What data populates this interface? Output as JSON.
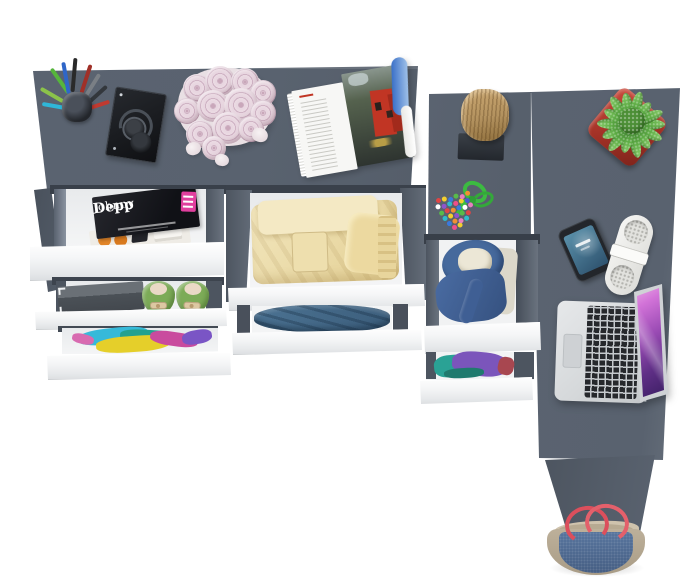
{
  "scene": {
    "description": "Top view of an anthracite gray L-shaped desk with white open drawers filled with clothes, shoes, magazines and accessories",
    "magazine_cover": {
      "title_line1": "Johnny",
      "title_line2": "Depp"
    },
    "colors": {
      "background": "#ffffff",
      "desk_top": "#5a6370",
      "desk_leg": "#4d5560",
      "cabinet_wall": "#4d5560",
      "drawer_front": "#ffffff",
      "drawer_interior": "#f4f5f6",
      "magazine_cover_black": "#101116",
      "badge_pink": "#e03f9e",
      "shoes_green": "#7cab57",
      "towels_yellow": "#e3cf93",
      "jeans_blue": "#4b7292",
      "jacket_denim": "#46699c",
      "shirts_purple": "#7b55bb",
      "stool_wood": "#b3925f",
      "candy_cord_green": "#3cbb41",
      "plant_pot_red": "#a33227",
      "plant_green": "#5fae46",
      "phone_screen_blue": "#5a90aa",
      "speaker_white": "#f6f6f4",
      "laptop_silver": "#d5d8da",
      "laptop_screen_purple": "#9a4bb4",
      "bag_denim": "#415a80",
      "bag_trim": "#bdb09a",
      "bag_strap_red": "#dc4f5c",
      "rose_pink": "#e2cdd8"
    },
    "items": [
      {
        "id": "pen-cup",
        "label": "cup with colored pens and pencils"
      },
      {
        "id": "headphones-tray",
        "label": "folded headphones on black tray"
      },
      {
        "id": "rose-bouquet",
        "label": "bouquet of pale pink roses with loose petals"
      },
      {
        "id": "open-magazine",
        "label": "open magazine with photo of red building"
      },
      {
        "id": "wooden-stool",
        "label": "wooden log stool on dark base"
      },
      {
        "id": "candy-beads",
        "label": "multicolored bead candy with green cord"
      },
      {
        "id": "potted-plant",
        "label": "green succulent in red square pot"
      },
      {
        "id": "smartphone",
        "label": "smartphone with blue lock screen"
      },
      {
        "id": "bluetooth-speaker",
        "label": "white capsule speaker"
      },
      {
        "id": "laptop",
        "label": "silver laptop with purple wallpaper"
      },
      {
        "id": "magazines-drawer",
        "label": "drawer with Johnny Depp magazine"
      },
      {
        "id": "box-and-shoes-drawer",
        "label": "drawer with gray box and green ballet flats"
      },
      {
        "id": "colorful-clothes-drawer",
        "label": "drawer with colorful clothes"
      },
      {
        "id": "towels-drawer",
        "label": "drawer with folded yellow towels"
      },
      {
        "id": "jeans-drawer",
        "label": "drawer with folded jeans"
      },
      {
        "id": "jacket-drawer",
        "label": "drawer with denim jacket"
      },
      {
        "id": "shirts-drawer",
        "label": "drawer with purple and teal shirts"
      },
      {
        "id": "tote-bag",
        "label": "denim tote bag with red straps"
      }
    ]
  }
}
